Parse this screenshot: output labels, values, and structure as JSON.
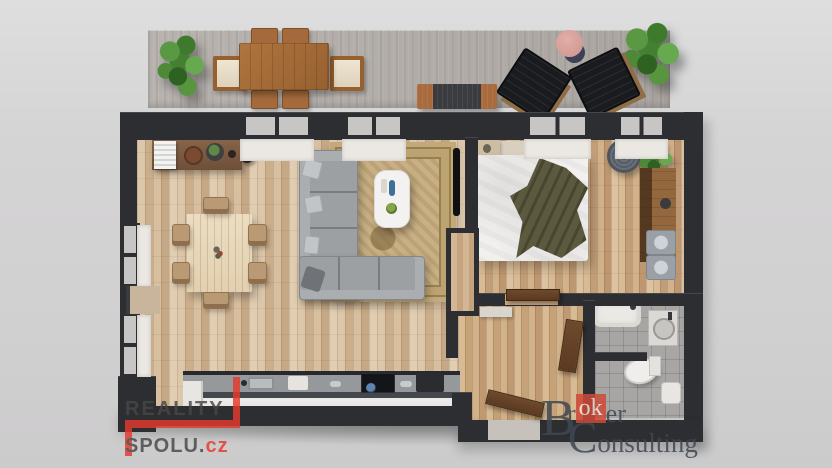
{
  "image_type": "3D top-down floor plan rendering of a two-room apartment with terrace",
  "background_color": "#d4d3d4",
  "palette": {
    "wall_dark": "#2c2e32",
    "wood_floor_living": "#d2b998",
    "wood_floor_bedroom": "#cdab85",
    "balcony_concrete": "#b3aeaa",
    "bathroom_tile": "#a8a6a4",
    "sofa_gray": "#9da0a3",
    "rug_tan": "#c8b084",
    "door_brown": "#6e4a2d",
    "plant_green": "#4d8a38",
    "logo_red": "#e6392c",
    "logo_gray": "#474747",
    "broker_text": "#3f4751",
    "broker_red": "#cf4a38"
  },
  "watermarks": {
    "reality_spolu": {
      "line1": "REALITY",
      "line2": "SPOLU.",
      "line2_suffix": "cz"
    },
    "broker_consulting": {
      "w1_cap": "B",
      "w1_pre": "r",
      "w1_mid": "ok",
      "w1_post": "er",
      "w2": "Consulting"
    }
  },
  "scene": {
    "rooms": [
      "balcony-terrace",
      "living-room-with-open-kitchen",
      "bedroom",
      "hallway",
      "bathroom"
    ],
    "furniture": [
      "potted-plants",
      "outdoor-dining-table-with-six-chairs",
      "barbecue-grill",
      "two-black-lounge-chairs",
      "pink-side-table",
      "sideboard-with-decor",
      "radiator",
      "floor-lamp",
      "dining-table-with-chairs",
      "ornate-area-rug",
      "gray-corner-sofa-with-pillows",
      "white-coffee-table",
      "wall-mounted-tv",
      "kitchen-counter-with-sink-and-cooktop",
      "double-bed-with-olive-blanket",
      "hanging-wicker-chair",
      "desk-console",
      "two-gray-stools",
      "bathtub",
      "washbasin",
      "toilet",
      "interior-doors"
    ]
  }
}
